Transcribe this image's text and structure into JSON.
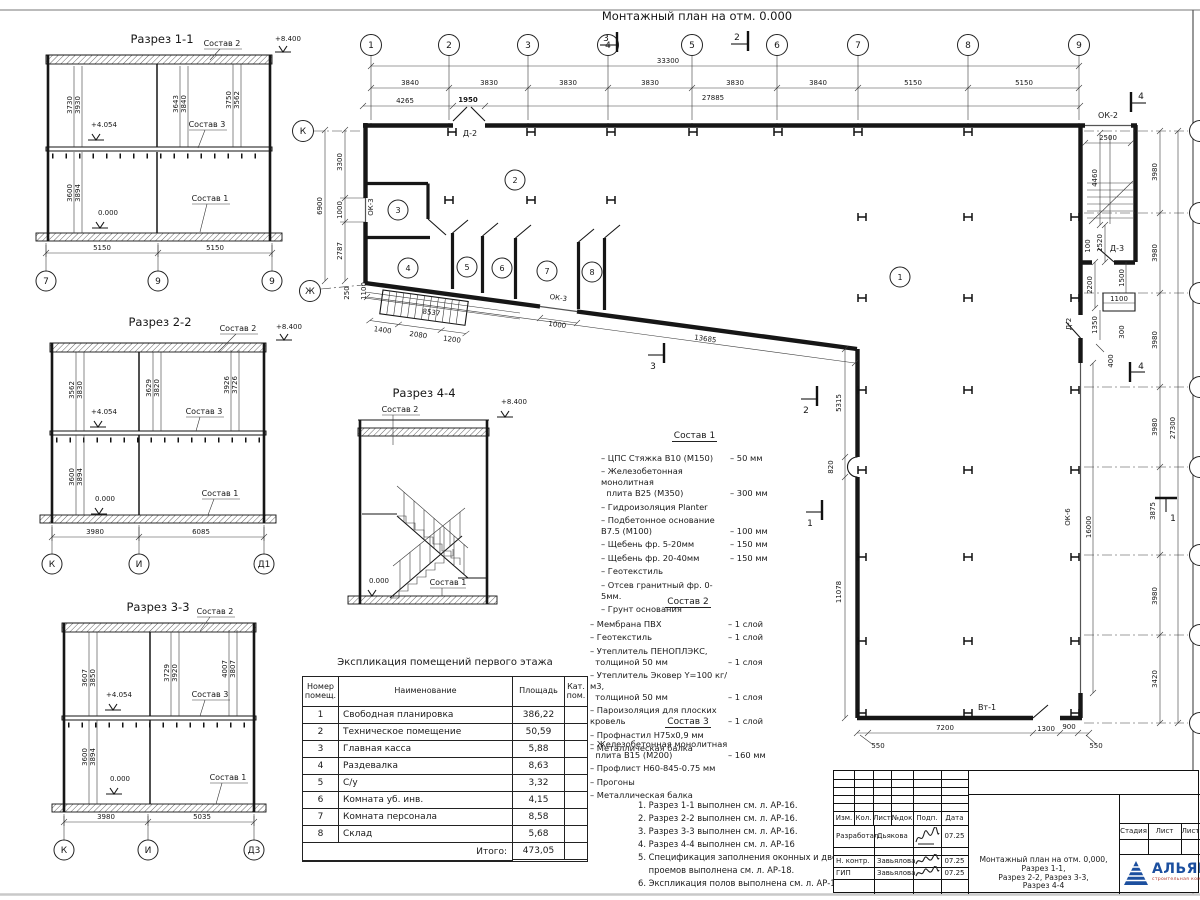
{
  "sheet": {
    "plan_title": "Монтажный план на отм. 0.000"
  },
  "common": {
    "sostav1": "Состав 1",
    "sostav2": "Состав 2",
    "sostav3": "Состав 3",
    "lvl_top": "+8.400",
    "lvl_mid": "+4.054",
    "lvl_zero": "0.000"
  },
  "plan": {
    "axes": [
      "1",
      "2",
      "3",
      "4",
      "5",
      "6",
      "7",
      "8",
      "9"
    ],
    "left_axes": [
      "К",
      "Ж"
    ],
    "total_top": "33300",
    "top_chain": [
      "3840",
      "3830",
      "3830",
      "3830",
      "3830",
      "3840",
      "5150",
      "5150"
    ],
    "sub_chain": [
      "4265",
      "1950",
      "27885"
    ],
    "left_overall": "6900",
    "left_chain": [
      "3300",
      "1000",
      "2787"
    ],
    "left_small": [
      "250",
      "1100"
    ],
    "rooms": [
      "1",
      "2",
      "3",
      "4",
      "5",
      "6",
      "7",
      "8"
    ],
    "labels": {
      "d2_top": "Д-2",
      "ok3_left": "ОК-3",
      "ok3_diag": "ОК-3",
      "ok2": "ОК-2",
      "ok6": "ОК-6",
      "d3": "Д-3",
      "d2_annex": "Д-2",
      "vt1": "Вт-1"
    },
    "ramp_chain": [
      "1400",
      "2080",
      "1200"
    ],
    "ramp_total": "8537",
    "diag_window": "1000",
    "diag_total": "13685",
    "east_chain": [
      "5315",
      "820",
      "11078"
    ],
    "east_window": "16000",
    "south_chain": [
      "7200",
      "1300",
      "900"
    ],
    "south_small": [
      "550",
      "550"
    ],
    "annex": [
      "2500",
      "4460",
      "1520",
      "100",
      "2200",
      "1500",
      "1100",
      "1350",
      "300",
      "400"
    ],
    "right_chain": [
      "3980",
      "3980",
      "3980",
      "3980",
      "3875",
      "3980",
      "3420"
    ],
    "right_total": "27300",
    "markers": {
      "m1": "1",
      "m2": "2",
      "m3": "3",
      "m4": "4"
    }
  },
  "s11": {
    "title": "Разрез 1-1",
    "du": [
      "3730",
      "3930",
      "3643",
      "3840",
      "3750",
      "3562"
    ],
    "dl": [
      "3600",
      "3894"
    ],
    "db": [
      "5150",
      "5150"
    ],
    "axes": [
      "7",
      "9",
      "9"
    ]
  },
  "s22": {
    "title": "Разрез 2-2",
    "du": [
      "3562",
      "3830",
      "3629",
      "3820",
      "3926",
      "3726"
    ],
    "dl": [
      "3600",
      "3894"
    ],
    "db": [
      "3980",
      "6085"
    ],
    "axes": [
      "К",
      "И",
      "Д1"
    ]
  },
  "s33": {
    "title": "Разрез 3-3",
    "du": [
      "3607",
      "3850",
      "3729",
      "3920",
      "4007",
      "3807"
    ],
    "dl": [
      "3600",
      "3894"
    ],
    "db": [
      "3980",
      "5035"
    ],
    "axes": [
      "К",
      "И",
      "Д3"
    ]
  },
  "s44": {
    "title": "Разрез 4-4"
  },
  "sostav1": {
    "title": "Состав 1",
    "items": [
      {
        "n": "– ЦПС Стяжка В10 (М150)",
        "v": "– 50 мм"
      },
      {
        "n": "– Железобетонная монолитная\n  плита В25 (М350)",
        "v": "– 300 мм"
      },
      {
        "n": "– Гидроизоляция Planter",
        "v": ""
      },
      {
        "n": "– Подбетонное основание В7.5 (М100)",
        "v": "– 100 мм"
      },
      {
        "n": "– Щебень фр. 5-20мм",
        "v": "– 150 мм"
      },
      {
        "n": "– Щебень фр. 20-40мм",
        "v": "– 150 мм"
      },
      {
        "n": "– Геотекстиль",
        "v": ""
      },
      {
        "n": "– Отсев гранитный фр. 0-5мм.",
        "v": ""
      },
      {
        "n": "– Грунт основания",
        "v": ""
      }
    ]
  },
  "sostav2": {
    "title": "Состав 2",
    "items": [
      {
        "n": "– Мембрана ПВХ",
        "v": "– 1 слой"
      },
      {
        "n": "– Геотекстиль",
        "v": "– 1 слой"
      },
      {
        "n": "– Утеплитель ПЕНОПЛЭКС,\n  толщиной 50 мм",
        "v": "– 1 слоя"
      },
      {
        "n": "– Утеплитель Эковер Y=100 кг/м3,\n  толщиной 50 мм",
        "v": "– 1 слоя"
      },
      {
        "n": "– Пароизоляция для плоских кровель",
        "v": "– 1 слой"
      },
      {
        "n": "– Профнастил Н75х0,9 мм",
        "v": ""
      },
      {
        "n": "– Металлическая балка",
        "v": ""
      }
    ]
  },
  "sostav3": {
    "title": "Состав 3",
    "items": [
      {
        "n": "– Железобетонная монолитная\n  плита В15 (М200)",
        "v": "– 160 мм"
      },
      {
        "n": "– Профлист Н60-845-0.75 мм",
        "v": ""
      },
      {
        "n": "– Прогоны",
        "v": ""
      },
      {
        "n": "– Металлическая балка",
        "v": ""
      }
    ]
  },
  "notes": [
    "1. Разрез 1-1 выполнен см. л. АР-16.",
    "2. Разрез 2-2 выполнен см. л. АР-16.",
    "3. Разрез 3-3 выполнен см. л. АР-16.",
    "4. Разрез 4-4 выполнен см. л. АР-16",
    "5. Спецификация заполнения оконных и дверных\n    проемов выполнена см. л. АР-18.",
    "6. Экспликация полов выполнена см. л. АР-19."
  ],
  "explication": {
    "title": "Экспликация помещений первого этажа",
    "headers": [
      "Номер\nпомещ.",
      "Наименование",
      "Площадь",
      "Кат.\nпом."
    ],
    "rows": [
      [
        "1",
        "Свободная планировка",
        "386,22"
      ],
      [
        "2",
        "Техническое помещение",
        "50,59"
      ],
      [
        "3",
        "Главная касса",
        "5,88"
      ],
      [
        "4",
        "Раздевалка",
        "8,63"
      ],
      [
        "5",
        "С/у",
        "3,32"
      ],
      [
        "6",
        "Комната уб. инв.",
        "4,15"
      ],
      [
        "7",
        "Комната персонала",
        "8,58"
      ],
      [
        "8",
        "Склад",
        "5,68"
      ]
    ],
    "total_label": "Итого:",
    "total_value": "473,05"
  },
  "titleblock": {
    "sign_headers": [
      "Изм.",
      "Кол.",
      "Лист",
      "№док",
      "Подп.",
      "Дата"
    ],
    "sign_rows": [
      {
        "role": "Разработал",
        "name": "Дьякова",
        "date": "07.25"
      },
      {
        "role": "Н. контр.",
        "name": "Завьялова",
        "date": "07.25"
      },
      {
        "role": "ГИП",
        "name": "Завьялова",
        "date": "07.25"
      }
    ],
    "doc_title": "Монтажный план на отм. 0,000, Разрез 1-1,\nРазрез 2-2, Разрез 3-3,\nРазрез 4-4",
    "stage_headers": [
      "Стадия",
      "Лист",
      "Лист"
    ],
    "logo": "АЛЬЯНС",
    "logo_sub": "строительная компания"
  }
}
